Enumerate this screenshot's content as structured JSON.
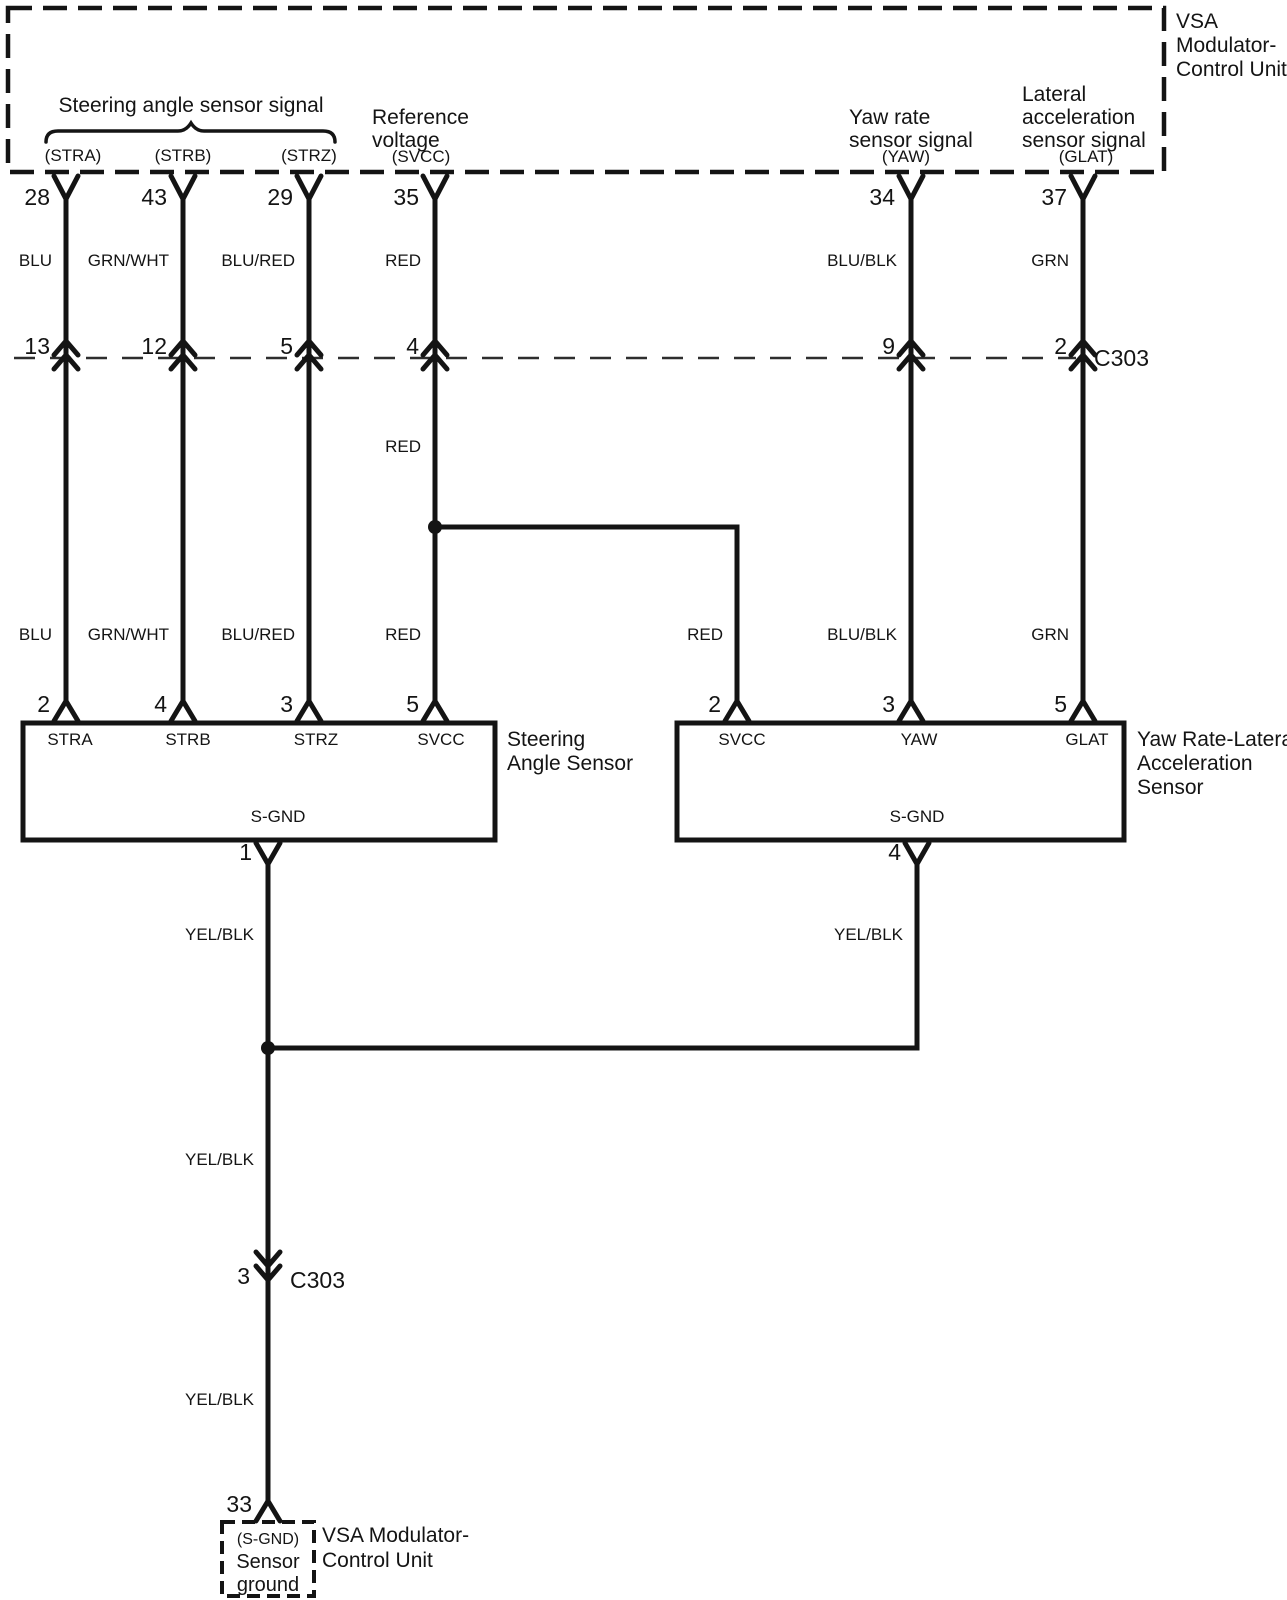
{
  "colors": {
    "ink": "#141414",
    "background": "#ffffff"
  },
  "vsa_unit_top": {
    "name_lines": [
      "VSA",
      "Modulator-",
      "Control Unit"
    ]
  },
  "header": {
    "steering_group": {
      "label": "Steering angle sensor signal",
      "sublabels": [
        "(STRA)",
        "(STRB)",
        "(STRZ)"
      ]
    },
    "reference_voltage": {
      "label_lines": [
        "Reference",
        "voltage"
      ],
      "sublabel": "(SVCC)"
    },
    "yaw_rate": {
      "label_lines": [
        "Yaw rate",
        "sensor signal"
      ],
      "sublabel": "(YAW)"
    },
    "lateral_accel": {
      "label_lines": [
        "Lateral",
        "acceleration",
        "sensor signal"
      ],
      "sublabel": "(GLAT)"
    }
  },
  "vsa_pins": [
    "28",
    "43",
    "29",
    "35",
    "34",
    "37"
  ],
  "wire_colors_upper": [
    "BLU",
    "GRN/WHT",
    "BLU/RED",
    "RED",
    "BLU/BLK",
    "GRN"
  ],
  "connector_c303_upper": {
    "name": "C303",
    "pins": [
      "13",
      "12",
      "5",
      "4",
      "9",
      "2"
    ]
  },
  "svcc_mid_color": "RED",
  "wire_colors_lower": [
    "BLU",
    "GRN/WHT",
    "BLU/RED",
    "RED",
    "RED",
    "BLU/BLK",
    "GRN"
  ],
  "sensor_pins": [
    "2",
    "4",
    "3",
    "5",
    "2",
    "3",
    "5"
  ],
  "steering_sensor": {
    "name_lines": [
      "Steering",
      "Angle Sensor"
    ],
    "terminals": [
      "STRA",
      "STRB",
      "STRZ",
      "SVCC"
    ],
    "ground_terminal": "S-GND",
    "ground_pin": "1"
  },
  "yaw_sensor": {
    "name_lines": [
      "Yaw Rate-Lateral",
      "Acceleration",
      "Sensor"
    ],
    "terminals": [
      "SVCC",
      "YAW",
      "GLAT"
    ],
    "ground_terminal": "S-GND",
    "ground_pin": "4"
  },
  "ground_wires": {
    "left_color": "YEL/BLK",
    "right_color": "YEL/BLK",
    "mid_color": "YEL/BLK",
    "lower_color": "YEL/BLK"
  },
  "connector_c303_lower": {
    "name": "C303",
    "pin": "3"
  },
  "vsa_unit_bottom": {
    "pin": "33",
    "terminal": "(S-GND)",
    "terminal_lines": [
      "Sensor",
      "ground"
    ],
    "name_lines": [
      "VSA Modulator-",
      "Control Unit"
    ]
  }
}
